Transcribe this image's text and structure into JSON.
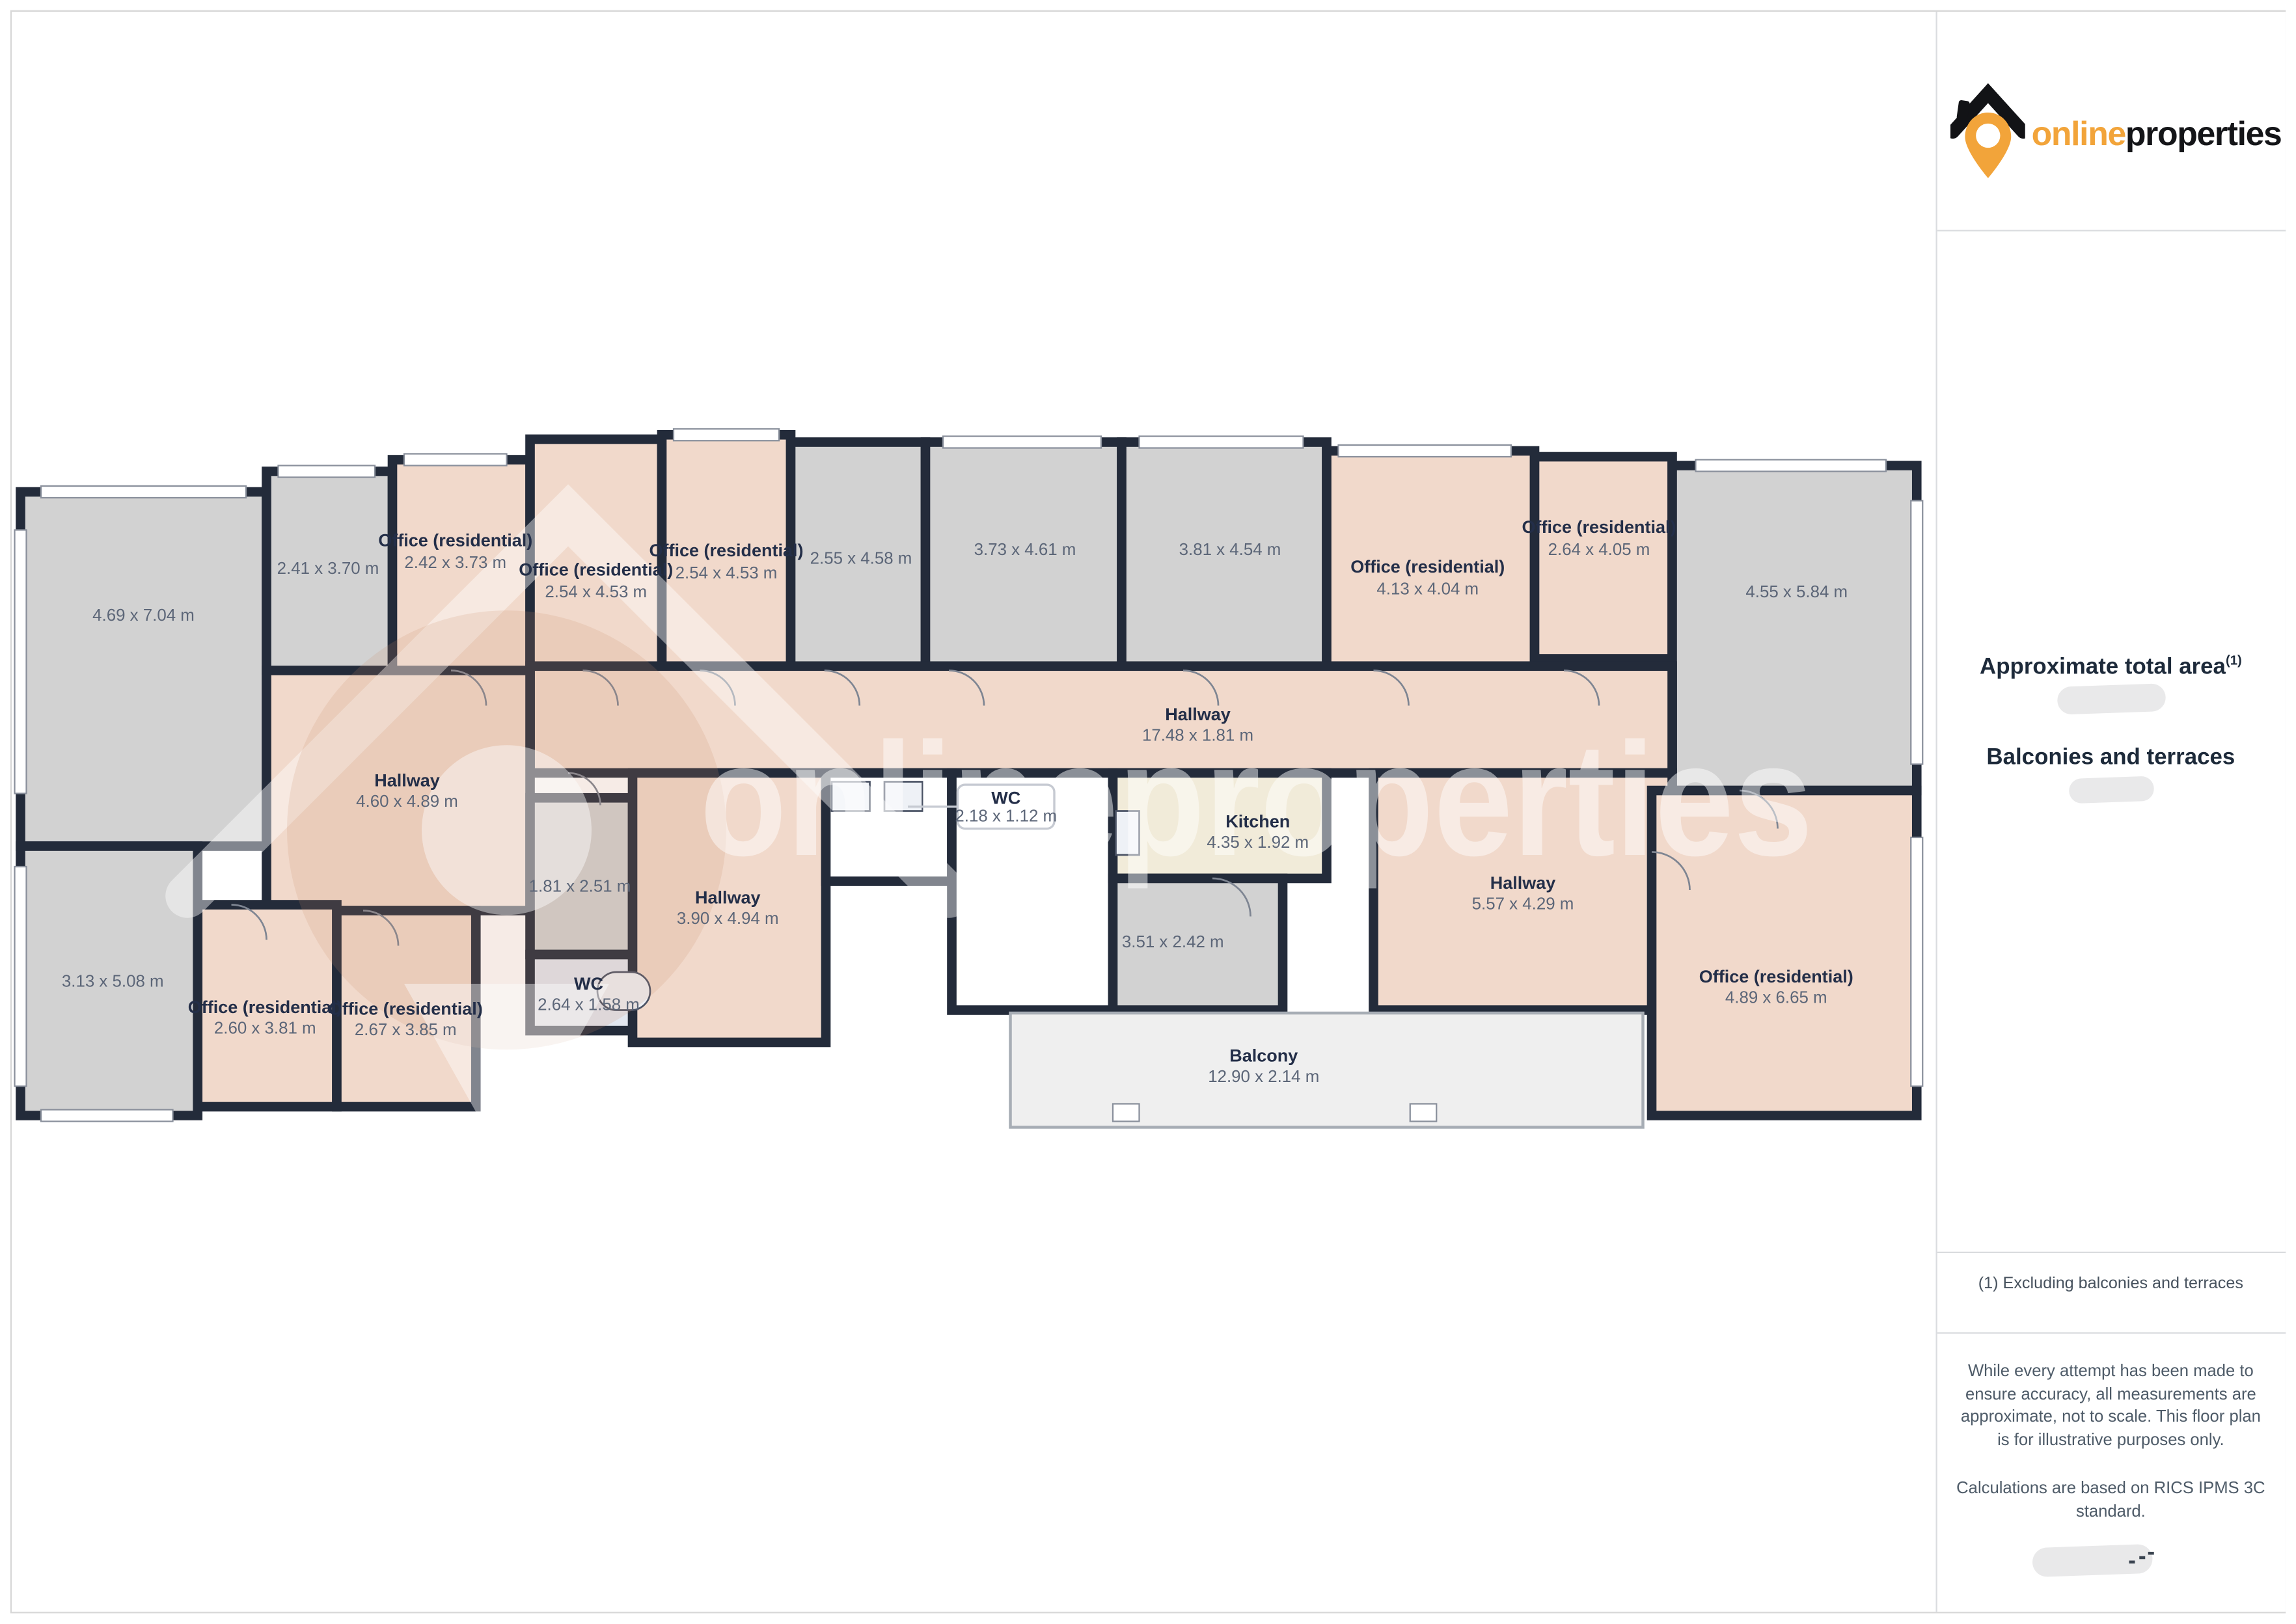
{
  "brand": {
    "online": "online",
    "properties": "properties"
  },
  "watermark": "onlineproperties",
  "sidebar": {
    "area_title": "Approximate total area",
    "area_footnote_marker": "(1)",
    "balconies_title": "Balconies and terraces",
    "footnote": "(1) Excluding balconies and terraces",
    "disclaimer_p1": "While every attempt has been made to ensure accuracy, all measurements are approximate, not to scale. This floor plan is for illustrative purposes only.",
    "disclaimer_p2": "Calculations are based on RICS IPMS 3C standard."
  },
  "rooms": [
    {
      "name": "",
      "dims": "4.69 x 7.04 m"
    },
    {
      "name": "",
      "dims": "2.41 x 3.70 m"
    },
    {
      "name": "Office (residential)",
      "dims": "2.42 x 3.73 m"
    },
    {
      "name": "Office (residential)",
      "dims": "2.54 x 4.53 m"
    },
    {
      "name": "Office (residential)",
      "dims": "2.54 x 4.53 m"
    },
    {
      "name": "",
      "dims": "2.55 x 4.58 m"
    },
    {
      "name": "",
      "dims": "3.73 x 4.61 m"
    },
    {
      "name": "",
      "dims": "3.81 x 4.54 m"
    },
    {
      "name": "Office (residential)",
      "dims": "4.13 x 4.04 m"
    },
    {
      "name": "Office (residential)",
      "dims": "2.64 x 4.05 m"
    },
    {
      "name": "",
      "dims": "4.55 x 5.84 m"
    },
    {
      "name": "Hallway",
      "dims": "17.48 x 1.81 m"
    },
    {
      "name": "Hallway",
      "dims": "4.60 x 4.89 m"
    },
    {
      "name": "",
      "dims": "1.81 x 2.51 m"
    },
    {
      "name": "WC",
      "dims": "2.64 x 1.58 m"
    },
    {
      "name": "Hallway",
      "dims": "3.90 x 4.94 m"
    },
    {
      "name": "WC",
      "dims": "2.18 x 1.12 m"
    },
    {
      "name": "Kitchen",
      "dims": "4.35 x 1.92 m"
    },
    {
      "name": "",
      "dims": "3.51 x 2.42 m"
    },
    {
      "name": "Hallway",
      "dims": "5.57 x 4.29 m"
    },
    {
      "name": "",
      "dims": "3.13 x 5.08 m"
    },
    {
      "name": "Office (residential)",
      "dims": "2.60 x 3.81 m"
    },
    {
      "name": "Office (residential)",
      "dims": "2.67 x 3.85 m"
    },
    {
      "name": "Office (residential)",
      "dims": "4.89 x 6.65 m"
    },
    {
      "name": "Balcony",
      "dims": "12.90 x 2.14 m"
    }
  ]
}
